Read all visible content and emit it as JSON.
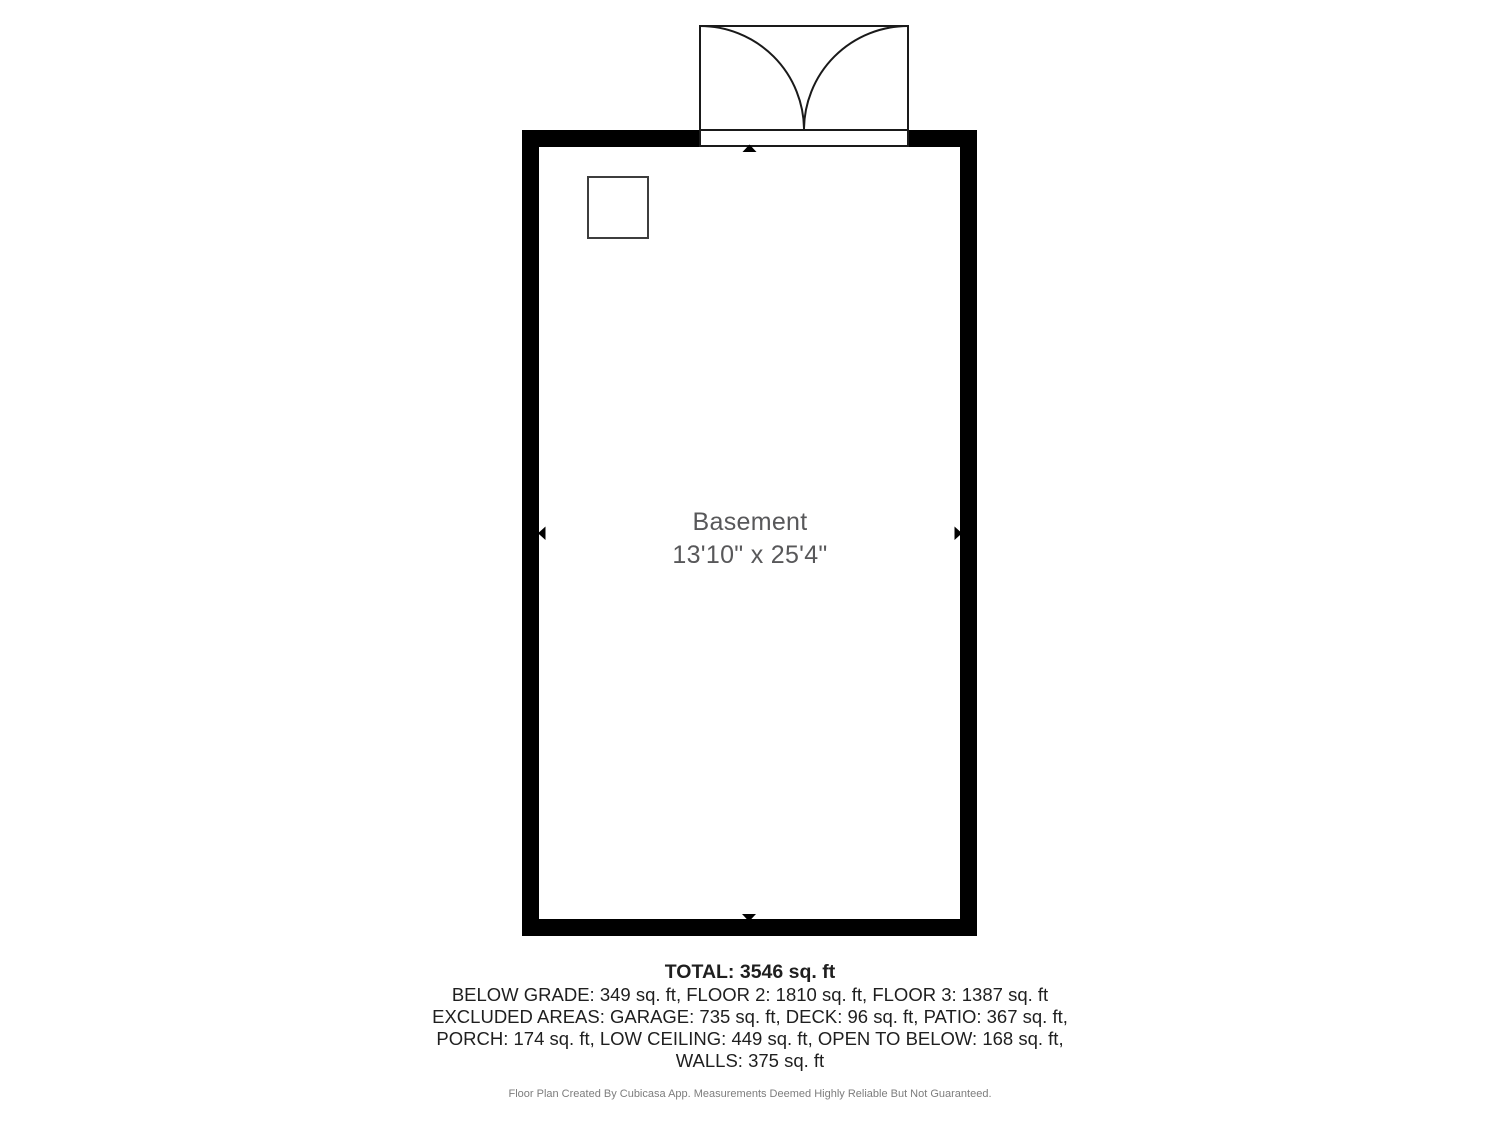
{
  "floor_plan": {
    "room": {
      "name": "Basement",
      "dimensions": "13'10\" x 25'4\""
    },
    "summary": {
      "total": "TOTAL: 3546 sq. ft",
      "lines": [
        "BELOW GRADE: 349 sq. ft, FLOOR 2: 1810 sq. ft, FLOOR 3: 1387 sq. ft",
        "EXCLUDED AREAS: GARAGE: 735 sq. ft, DECK: 96 sq. ft, PATIO: 367 sq. ft,",
        "PORCH: 174 sq. ft, LOW CEILING: 449 sq. ft, OPEN TO BELOW: 168 sq. ft,",
        "WALLS: 375 sq. ft"
      ]
    },
    "footer": "Floor Plan Created By Cubicasa App. Measurements Deemed Highly Reliable But Not Guaranteed.",
    "colors": {
      "wall": "#000000",
      "door_outline": "#1a1a1a",
      "column_outline": "#3d3d3d",
      "room_label": "#58585a",
      "summary_text": "#1f1f1f",
      "footer_text": "#7d7d7d",
      "background": "#ffffff"
    }
  }
}
